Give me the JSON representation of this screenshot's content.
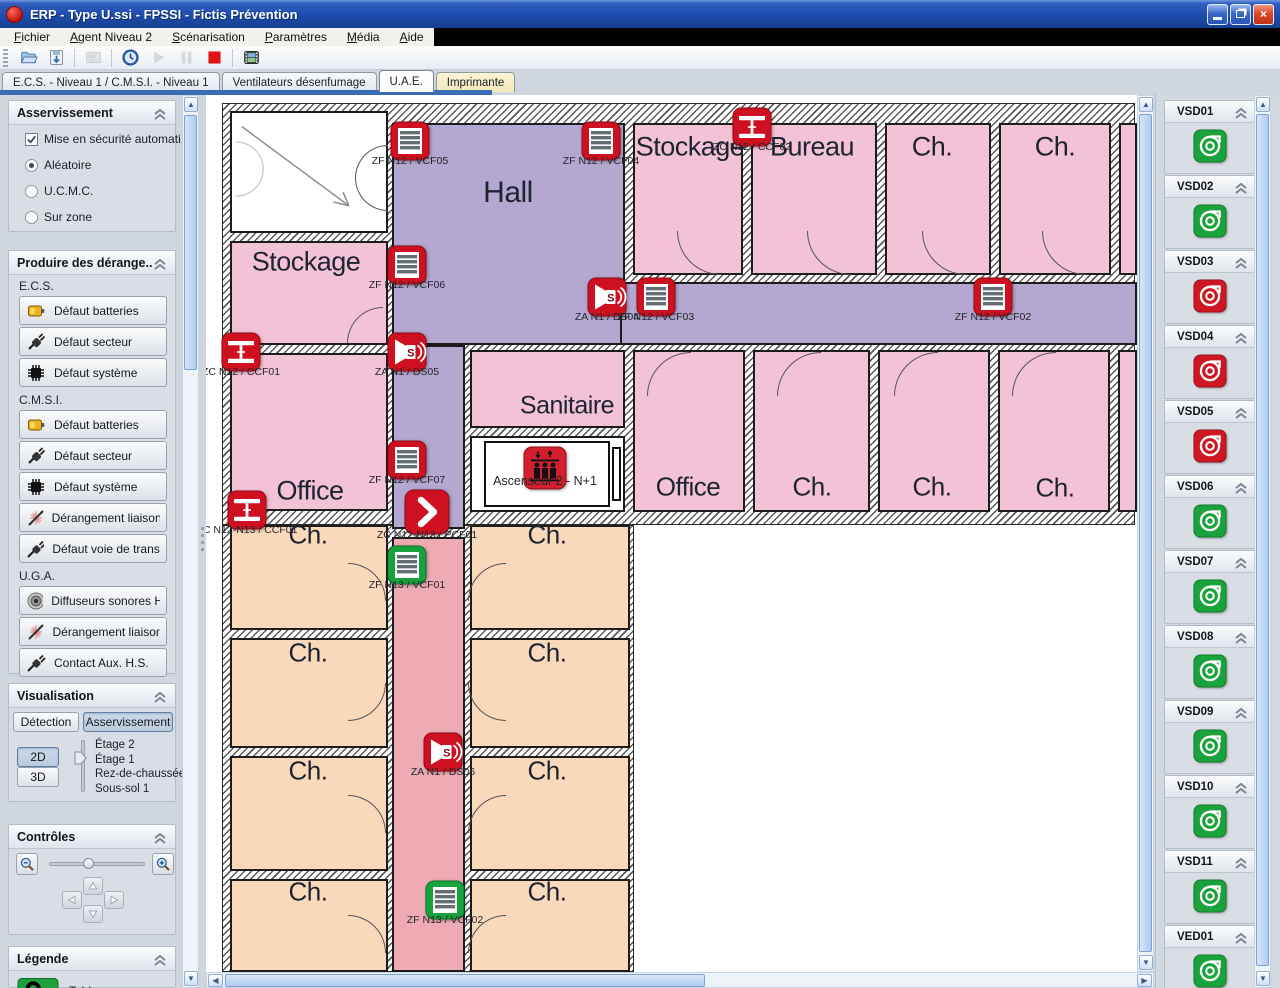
{
  "window": {
    "title": "ERP - Type U.ssi - FPSSI - Fictis Prévention"
  },
  "menu": {
    "items": [
      "Fichier",
      "Agent Niveau 2",
      "Scénarisation",
      "Paramètres",
      "Média",
      "Aide"
    ]
  },
  "toolbar": {
    "buttons": [
      {
        "name": "open-project-icon",
        "glyph": "open",
        "enabled": true
      },
      {
        "name": "save-icon",
        "glyph": "save",
        "enabled": true
      },
      {
        "name": "panel-icon",
        "glyph": "panel",
        "enabled": false
      },
      {
        "name": "clock-icon",
        "glyph": "clock",
        "enabled": true
      },
      {
        "name": "play-icon",
        "glyph": "play",
        "enabled": false
      },
      {
        "name": "pause-icon",
        "glyph": "pause",
        "enabled": false
      },
      {
        "name": "stop-icon",
        "glyph": "stop",
        "enabled": true
      },
      {
        "name": "media-icon",
        "glyph": "film",
        "enabled": true
      }
    ]
  },
  "tabs": [
    {
      "label": "E.C.S. - Niveau 1 / C.M.S.I. - Niveau 1",
      "active": false,
      "style": "normal"
    },
    {
      "label": "Ventilateurs désenfumage",
      "active": false,
      "style": "normal"
    },
    {
      "label": "U.A.E.",
      "active": true,
      "style": "normal"
    },
    {
      "label": "Imprimante",
      "active": false,
      "style": "cream"
    }
  ],
  "sidebar": {
    "asservissement": {
      "title": "Asservissement",
      "checkbox_label": "Mise en sécurité automati...",
      "checkbox_checked": true,
      "radios": [
        "Aléatoire",
        "U.C.M.C.",
        "Sur zone"
      ],
      "selected_radio": "Aléatoire"
    },
    "derangements": {
      "title": "Produire des dérange...",
      "groups": [
        {
          "label": "E.C.S.",
          "buttons": [
            {
              "icon": "battery-icon",
              "label": "Défaut batteries"
            },
            {
              "icon": "plug-icon",
              "label": "Défaut secteur"
            },
            {
              "icon": "chip-icon",
              "label": "Défaut système"
            }
          ]
        },
        {
          "label": "C.M.S.I.",
          "buttons": [
            {
              "icon": "battery-icon",
              "label": "Défaut batteries"
            },
            {
              "icon": "plug-icon",
              "label": "Défaut secteur"
            },
            {
              "icon": "chip-icon",
              "label": "Défaut système"
            },
            {
              "icon": "broken-link-icon",
              "label": "Dérangement liaison ..."
            },
            {
              "icon": "cable-icon",
              "label": "Défaut voie de trans..."
            }
          ]
        },
        {
          "label": "U.G.A.",
          "buttons": [
            {
              "icon": "speaker-icon",
              "label": "Diffuseurs sonores H.S."
            },
            {
              "icon": "broken-link-icon",
              "label": "Dérangement liaisons"
            },
            {
              "icon": "cable-icon",
              "label": "Contact Aux. H.S."
            }
          ]
        }
      ]
    },
    "visualisation": {
      "title": "Visualisation",
      "mode_buttons": [
        "Détection",
        "Asservissement"
      ],
      "active_mode": "Asservissement",
      "view_buttons": [
        "2D",
        "3D"
      ],
      "active_view": "2D",
      "floors": [
        "Étage 2",
        "Étage 1",
        "Rez-de-chaussée",
        "Sous-sol 1"
      ],
      "current_floor": "Étage 1"
    },
    "controles": {
      "title": "Contrôles"
    },
    "legende": {
      "title": "Légende",
      "items": [
        {
          "icon": "tableau-icon",
          "label": "Tableau"
        }
      ]
    }
  },
  "right_panel": {
    "groups": [
      {
        "title": "VSD01",
        "status": "ok"
      },
      {
        "title": "VSD02",
        "status": "ok"
      },
      {
        "title": "VSD03",
        "status": "fault"
      },
      {
        "title": "VSD04",
        "status": "fault"
      },
      {
        "title": "VSD05",
        "status": "fault"
      },
      {
        "title": "VSD06",
        "status": "ok"
      },
      {
        "title": "VSD07",
        "status": "ok"
      },
      {
        "title": "VSD08",
        "status": "ok"
      },
      {
        "title": "VSD09",
        "status": "ok"
      },
      {
        "title": "VSD10",
        "status": "ok"
      },
      {
        "title": "VSD11",
        "status": "ok"
      },
      {
        "title": "VED01",
        "status": "ok"
      }
    ]
  },
  "plan": {
    "colors": {
      "pink": "#f3c2d7",
      "purple": "#b4a7d0",
      "peach": "#fad9ba",
      "red": "#efabb4",
      "device_red": "#cf1021",
      "device_green": "#17a23d"
    },
    "walls": [
      {
        "x": 0,
        "y": 8,
        "w": 913,
        "h": 422
      },
      {
        "x": 0,
        "y": 430,
        "w": 412,
        "h": 447
      }
    ],
    "rooms": [
      {
        "name": "stairwell",
        "color": "white",
        "x": 8,
        "y": 16,
        "w": 158,
        "h": 122,
        "stairs": true
      },
      {
        "name": "hall",
        "color": "purple",
        "x": 170,
        "y": 28,
        "w": 233,
        "h": 222
      },
      {
        "name": "corridor-horizontal",
        "color": "purple",
        "x": 398,
        "y": 187,
        "w": 517,
        "h": 63
      },
      {
        "name": "corridor-vertical-upper",
        "color": "purple",
        "x": 170,
        "y": 250,
        "w": 73,
        "h": 184
      },
      {
        "name": "corridor-vertical-lower",
        "color": "red",
        "x": 170,
        "y": 442,
        "w": 73,
        "h": 435
      },
      {
        "name": "stockage-nw",
        "color": "pink",
        "x": 8,
        "y": 146,
        "w": 158,
        "h": 104
      },
      {
        "name": "office-west",
        "color": "pink",
        "x": 8,
        "y": 258,
        "w": 158,
        "h": 158
      },
      {
        "name": "stockage-ne",
        "color": "pink",
        "x": 411,
        "y": 28,
        "w": 110,
        "h": 152
      },
      {
        "name": "bureau",
        "color": "pink",
        "x": 529,
        "y": 28,
        "w": 126,
        "h": 152
      },
      {
        "name": "ch-ne-1",
        "color": "pink",
        "x": 663,
        "y": 28,
        "w": 106,
        "h": 152
      },
      {
        "name": "ch-ne-2",
        "color": "pink",
        "x": 777,
        "y": 28,
        "w": 112,
        "h": 152
      },
      {
        "name": "room-ne-partial",
        "color": "pink",
        "x": 897,
        "y": 28,
        "w": 18,
        "h": 152
      },
      {
        "name": "sanitaire",
        "color": "pink",
        "x": 248,
        "y": 255,
        "w": 155,
        "h": 78
      },
      {
        "name": "ascenseur-zone",
        "color": "white",
        "x": 248,
        "y": 341,
        "w": 155,
        "h": 76
      },
      {
        "name": "ascenseur-box",
        "color": "white",
        "x": 262,
        "y": 346,
        "w": 126,
        "h": 66,
        "box": true
      },
      {
        "name": "ascenseur-slot",
        "color": "white",
        "x": 390,
        "y": 352,
        "w": 9,
        "h": 54,
        "box": true
      },
      {
        "name": "office-mid",
        "color": "pink",
        "x": 411,
        "y": 255,
        "w": 112,
        "h": 162
      },
      {
        "name": "ch-mid-1",
        "color": "pink",
        "x": 531,
        "y": 255,
        "w": 117,
        "h": 162
      },
      {
        "name": "ch-mid-2",
        "color": "pink",
        "x": 656,
        "y": 255,
        "w": 112,
        "h": 162
      },
      {
        "name": "ch-mid-3",
        "color": "pink",
        "x": 776,
        "y": 255,
        "w": 112,
        "h": 162
      },
      {
        "name": "room-mid-partial",
        "color": "pink",
        "x": 896,
        "y": 255,
        "w": 19,
        "h": 162
      },
      {
        "name": "ch-a1",
        "color": "peach",
        "x": 8,
        "y": 430,
        "w": 158,
        "h": 105
      },
      {
        "name": "ch-b1",
        "color": "peach",
        "x": 248,
        "y": 430,
        "w": 160,
        "h": 105
      },
      {
        "name": "ch-a2",
        "color": "peach",
        "x": 8,
        "y": 543,
        "w": 158,
        "h": 110
      },
      {
        "name": "ch-b2",
        "color": "peach",
        "x": 248,
        "y": 543,
        "w": 160,
        "h": 110
      },
      {
        "name": "ch-a3",
        "color": "peach",
        "x": 8,
        "y": 661,
        "w": 158,
        "h": 115
      },
      {
        "name": "ch-b3",
        "color": "peach",
        "x": 248,
        "y": 661,
        "w": 160,
        "h": 115
      },
      {
        "name": "ch-a4",
        "color": "peach",
        "x": 8,
        "y": 784,
        "w": 158,
        "h": 93
      },
      {
        "name": "ch-b4",
        "color": "peach",
        "x": 248,
        "y": 784,
        "w": 160,
        "h": 93
      }
    ],
    "labels": [
      {
        "text": "Hall",
        "x": 286,
        "y": 98,
        "size": 30
      },
      {
        "text": "Stockage",
        "x": 84,
        "y": 167,
        "size": 27
      },
      {
        "text": "Stockage",
        "x": 468,
        "y": 52,
        "size": 27
      },
      {
        "text": "Bureau",
        "x": 590,
        "y": 52,
        "size": 27
      },
      {
        "text": "Ch.",
        "x": 710,
        "y": 52,
        "size": 27
      },
      {
        "text": "Ch.",
        "x": 833,
        "y": 52,
        "size": 27
      },
      {
        "text": "Sanitaire",
        "x": 345,
        "y": 311,
        "size": 25
      },
      {
        "text": "Office",
        "x": 88,
        "y": 396,
        "size": 27
      },
      {
        "text": "Office",
        "x": 466,
        "y": 392,
        "size": 26
      },
      {
        "text": "Ch.",
        "x": 590,
        "y": 392,
        "size": 26
      },
      {
        "text": "Ch.",
        "x": 710,
        "y": 392,
        "size": 26
      },
      {
        "text": "Ch.",
        "x": 833,
        "y": 393,
        "size": 26
      },
      {
        "text": "Ch.",
        "x": 86,
        "y": 440,
        "size": 26
      },
      {
        "text": "Ch.",
        "x": 325,
        "y": 440,
        "size": 26
      },
      {
        "text": "Ch.",
        "x": 86,
        "y": 558,
        "size": 26
      },
      {
        "text": "Ch.",
        "x": 325,
        "y": 558,
        "size": 26
      },
      {
        "text": "Ch.",
        "x": 86,
        "y": 676,
        "size": 26
      },
      {
        "text": "Ch.",
        "x": 325,
        "y": 676,
        "size": 26
      },
      {
        "text": "Ch.",
        "x": 86,
        "y": 797,
        "size": 26
      },
      {
        "text": "Ch.",
        "x": 325,
        "y": 797,
        "size": 26
      }
    ],
    "devices": [
      {
        "id": "ZF N12 / VCF05",
        "type": "vcf",
        "state": "red",
        "x": 188,
        "y": 46
      },
      {
        "id": "ZF N12 / VCF04",
        "type": "vcf",
        "state": "red",
        "x": 379,
        "y": 46
      },
      {
        "id": "ZF N12 / VCF06",
        "type": "vcf",
        "state": "red",
        "x": 185,
        "y": 170
      },
      {
        "id": "ZA N1 / DS04",
        "type": "ds",
        "state": "red",
        "x": 385,
        "y": 202
      },
      {
        "id": "ZF N12 / VCF03",
        "type": "vcf",
        "state": "red",
        "x": 434,
        "y": 202
      },
      {
        "id": "ZF N12 / VCF02",
        "type": "vcf",
        "state": "red",
        "x": 771,
        "y": 202
      },
      {
        "id": "ZC N12 / CCF02",
        "type": "ccf",
        "state": "red",
        "x": 530,
        "y": 32
      },
      {
        "id": "ZC N12 / CCF01",
        "type": "ccf",
        "state": "red",
        "x": 19,
        "y": 257
      },
      {
        "id": "ZA N1 / DS05",
        "type": "ds",
        "state": "red",
        "x": 185,
        "y": 257
      },
      {
        "id": "ZF N12 / VCF07",
        "type": "vcf",
        "state": "red",
        "x": 185,
        "y": 365
      },
      {
        "id": "ZC N12-N13 / CCF01",
        "type": "ccf",
        "state": "red",
        "x": 25,
        "y": 415
      },
      {
        "id": "ZC N12-N13 / PCF01",
        "type": "pcf",
        "state": "red",
        "x": 205,
        "y": 417,
        "size": 46
      },
      {
        "id": "ZF N13 / VCF01",
        "type": "vcf",
        "state": "green",
        "x": 185,
        "y": 470
      },
      {
        "id": "Ascenseur 2 - N+1",
        "type": "asc",
        "state": "red",
        "x": 323,
        "y": 373,
        "size": 44
      },
      {
        "id": "ZA N1 / DS06",
        "type": "ds",
        "state": "red",
        "x": 221,
        "y": 657
      },
      {
        "id": "ZF N13 / VCF02",
        "type": "vcf",
        "state": "green",
        "x": 223,
        "y": 805
      }
    ],
    "arcs": [
      {
        "x": 133,
        "y": 50,
        "r": 33,
        "q": "tl"
      },
      {
        "x": 133,
        "y": 83,
        "r": 33,
        "q": "bl"
      },
      {
        "x": 125,
        "y": 212,
        "r": 36,
        "q": "tl"
      },
      {
        "x": 455,
        "y": 136,
        "r": 44,
        "q": "bl"
      },
      {
        "x": 585,
        "y": 136,
        "r": 44,
        "q": "bl"
      },
      {
        "x": 700,
        "y": 136,
        "r": 44,
        "q": "bl"
      },
      {
        "x": 820,
        "y": 136,
        "r": 44,
        "q": "bl"
      },
      {
        "x": 425,
        "y": 257,
        "r": 44,
        "q": "tl"
      },
      {
        "x": 555,
        "y": 257,
        "r": 44,
        "q": "tl"
      },
      {
        "x": 672,
        "y": 257,
        "r": 44,
        "q": "tl"
      },
      {
        "x": 790,
        "y": 257,
        "r": 44,
        "q": "tl"
      },
      {
        "x": 126,
        "y": 468,
        "r": 38,
        "q": "tr"
      },
      {
        "x": 246,
        "y": 468,
        "r": 38,
        "q": "tl"
      },
      {
        "x": 126,
        "y": 588,
        "r": 38,
        "q": "br"
      },
      {
        "x": 246,
        "y": 588,
        "r": 38,
        "q": "bl"
      },
      {
        "x": 126,
        "y": 700,
        "r": 38,
        "q": "tr"
      },
      {
        "x": 246,
        "y": 700,
        "r": 38,
        "q": "tl"
      },
      {
        "x": 126,
        "y": 820,
        "r": 38,
        "q": "tr"
      },
      {
        "x": 246,
        "y": 820,
        "r": 38,
        "q": "tl"
      }
    ]
  }
}
